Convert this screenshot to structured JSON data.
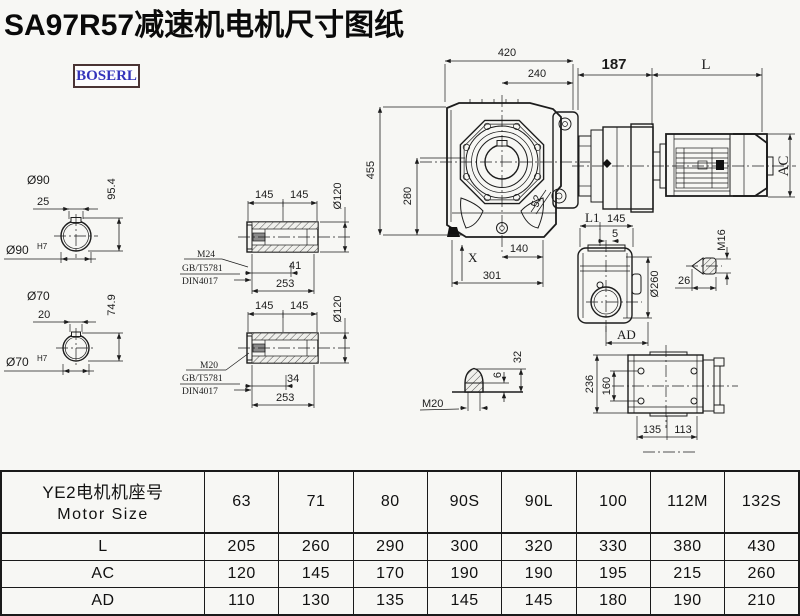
{
  "page": {
    "title": "SA97R57减速机电机尺寸图纸"
  },
  "logo": {
    "text": "BOSERL"
  },
  "colors": {
    "ink": "#1c1c1c",
    "logo_text": "#3333bb",
    "logo_border": "#4a3434",
    "background": "#f7f7f4"
  },
  "main_view": {
    "dim_width_total": "420",
    "dim_width_flange": "240",
    "dim_adapter": "187",
    "dim_motor_length": "L",
    "dim_motor_height": "AC",
    "dim_height_total": "455",
    "dim_height_axis": "280",
    "dim_52": "52",
    "dim_x": "X",
    "dim_140": "140",
    "dim_301": "301"
  },
  "output_shaft_top": {
    "dim_145_left": "145",
    "dim_145_right": "145",
    "dim_dia": "Ø120",
    "thread": "M24",
    "standard_gb": "GB/T5781",
    "standard_din": "DIN4017",
    "dim_depth": "41",
    "dim_length": "253"
  },
  "output_shaft_bottom": {
    "dim_145_left": "145",
    "dim_145_right": "145",
    "dim_dia": "Ø120",
    "thread": "M20",
    "standard_gb": "GB/T5781",
    "standard_din": "DIN4017",
    "dim_depth": "34",
    "dim_length": "253"
  },
  "bore_top": {
    "dia": "Ø90",
    "key_width": "25",
    "key_height": "95.4",
    "fit_base": "Ø90",
    "fit_sup": "H7"
  },
  "bore_bottom": {
    "dia": "Ø70",
    "key_width": "20",
    "key_height": "74.9",
    "fit_base": "Ø70",
    "fit_sup": "H7"
  },
  "side_view": {
    "dim_l1": "L1",
    "dim_145": "145",
    "dim_5": "5",
    "dim_dia": "Ø260",
    "dim_ad": "AD",
    "plug_thread": "M16",
    "dim_26": "26"
  },
  "vent_plug": {
    "thread": "M20",
    "dim_6": "6",
    "dim_32": "32"
  },
  "top_view": {
    "dim_236": "236",
    "dim_160": "160",
    "dim_135": "135",
    "dim_113": "113"
  },
  "table": {
    "header_cn": "YE2电机机座号",
    "header_en": "Motor Size",
    "sizes": [
      "63",
      "71",
      "80",
      "90S",
      "90L",
      "100",
      "112M",
      "132S"
    ],
    "rows": [
      {
        "label": "L",
        "values": [
          "205",
          "260",
          "290",
          "300",
          "320",
          "330",
          "380",
          "430"
        ]
      },
      {
        "label": "AC",
        "values": [
          "120",
          "145",
          "170",
          "190",
          "190",
          "195",
          "215",
          "260"
        ]
      },
      {
        "label": "AD",
        "values": [
          "110",
          "130",
          "135",
          "145",
          "145",
          "180",
          "190",
          "210"
        ]
      }
    ]
  }
}
